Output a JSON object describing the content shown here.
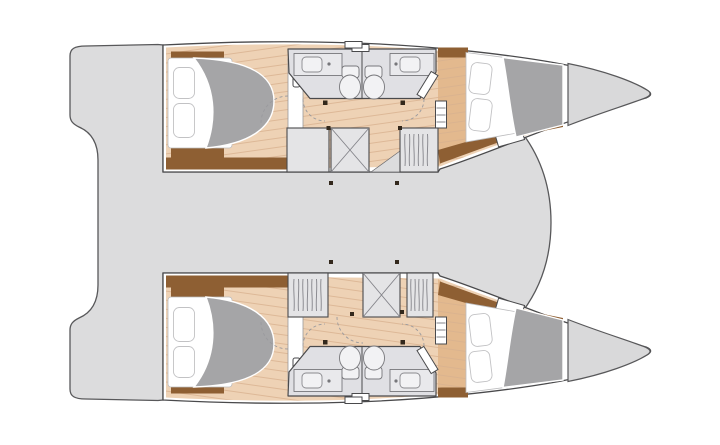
{
  "title": "",
  "colors": {
    "page_bg": "#ffffff",
    "deck": "#dcdcdd",
    "deck_outline": "#58585a",
    "hull_outline": "#4a4a4c",
    "wood": "#eed2b5",
    "wood_plank": "#d8b190",
    "wood_dark": "#e3b98e",
    "trim_brown": "#8e5f33",
    "duvet": "#a5a5a7",
    "bathroom": "#e0e0e4",
    "cabinet": "#e4e4e6",
    "fixture": "#f2f2f4",
    "fixture_line": "#77777b",
    "bow_locker": "#d9d9da",
    "dot_dark": "#33281c",
    "arc": "#9a9a9e"
  },
  "vessel": {
    "kind": "catamaran-floorplan",
    "layout": "4-cabin, 2-bathroom charter version",
    "orientation": "bows-right",
    "bridge_deck": "open saloon-cockpit area",
    "stern": "aft boarding platforms with recessed transom",
    "bows": "anchor lockers",
    "hulls": [
      {
        "name": "upper hull",
        "cabins": [
          "aft double cabin",
          "bathroom pair with twin toilets and washbasins",
          "forward double cabin"
        ],
        "storage": [
          "cabinet",
          "cross-braced locker",
          "companionway step",
          "hanging locker"
        ]
      },
      {
        "name": "lower hull",
        "cabins": [
          "aft double cabin",
          "bathroom pair with twin toilets and washbasins",
          "forward double cabin"
        ],
        "storage": [
          "hanging locker",
          "door gap",
          "cross-braced locker",
          "hanging locker"
        ]
      }
    ]
  }
}
